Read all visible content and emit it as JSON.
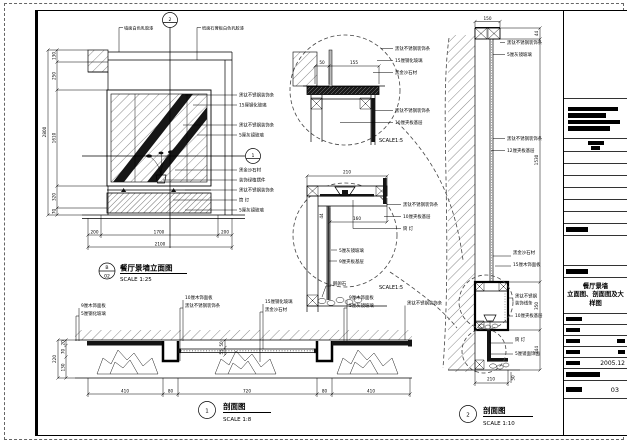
{
  "titleblock": {
    "t1": "餐厅景墙",
    "t2": "立面图、剖面图及大样图",
    "date": "2005.12",
    "no": "03"
  },
  "elev": {
    "m2": "2",
    "m1": "1",
    "bl": "B",
    "bn": "02",
    "title": "餐厅景墙立面图",
    "scale": "SCALE 1:25",
    "ct": [
      "墙面白色乳胶漆",
      "纸面石膏板白色乳胶漆"
    ],
    "cr": [
      "黑钛不锈钢装饰条",
      "15厘钢化玻璃",
      "黑钛不锈钢装饰条",
      "5厘灰镜玻璃",
      "黑金沙石材",
      "装饰绿植摆件",
      "黑钛不锈钢装饰条",
      "筒 灯",
      "5厘灰镜玻璃"
    ],
    "dlt": "2800",
    "dls": [
      "130",
      "250",
      "1610",
      "320",
      "70"
    ],
    "dbs": [
      "200",
      "1700",
      "200"
    ],
    "dbt": "2100"
  },
  "dA": {
    "scale": "SCALE1:5",
    "d": [
      "50",
      "155"
    ],
    "cr": [
      "黑钛不锈钢装饰条",
      "15厘钢化玻璃",
      "黑金沙石材"
    ],
    "cl": [
      "黑钛不锈钢装饰条",
      "10厘夹板基层"
    ]
  },
  "dB": {
    "scale": "SCALE1:5",
    "dt": "210",
    "di": "160",
    "ds": "44",
    "cr": [
      "黑钛不锈钢装饰条",
      "10厘夹板基层",
      "筒 灯"
    ],
    "ci": [
      "5厘灰镜玻璃",
      "9厘夹板基层",
      "鹅卵石"
    ]
  },
  "s2": {
    "no": "2",
    "title": "剖面图",
    "scale": "SCALE 1:10",
    "d150": "150",
    "d44": "44",
    "d1530": "1530",
    "d350": "350",
    "d244": "244",
    "d210": "210",
    "d50": "50",
    "ct": [
      "黑钛不锈钢装饰条",
      "5厘灰镜玻璃"
    ],
    "cm": [
      "黑钛不锈钢装饰条",
      "12厘夹板基层"
    ],
    "cc": [
      "黑金沙石材",
      "15厘木饰面板"
    ],
    "crr": [
      "黑钛不锈钢",
      "装饰线条",
      "10厘夹板基层"
    ],
    "cb": [
      "筒 灯",
      "5厘镜面饰面"
    ]
  },
  "s1": {
    "no": "1",
    "title": "剖面图",
    "scale": "SCALE 1:8",
    "dlt": "220",
    "dls": [
      "20",
      "70",
      "130"
    ],
    "dm": [
      "50",
      "55"
    ],
    "dbs": [
      "410",
      "80",
      "720",
      "80",
      "410"
    ],
    "g": [
      [
        "9厘木饰面板",
        "5厘钢化玻璃"
      ],
      [
        "10厘木饰面板",
        "黑钛不锈钢装饰条"
      ],
      [
        "15厘钢化玻璃",
        "黑金沙石材"
      ],
      [
        "9厘木饰面板",
        "5厘灰镜玻璃"
      ],
      [
        "黑钛不锈钢装饰条"
      ]
    ]
  }
}
